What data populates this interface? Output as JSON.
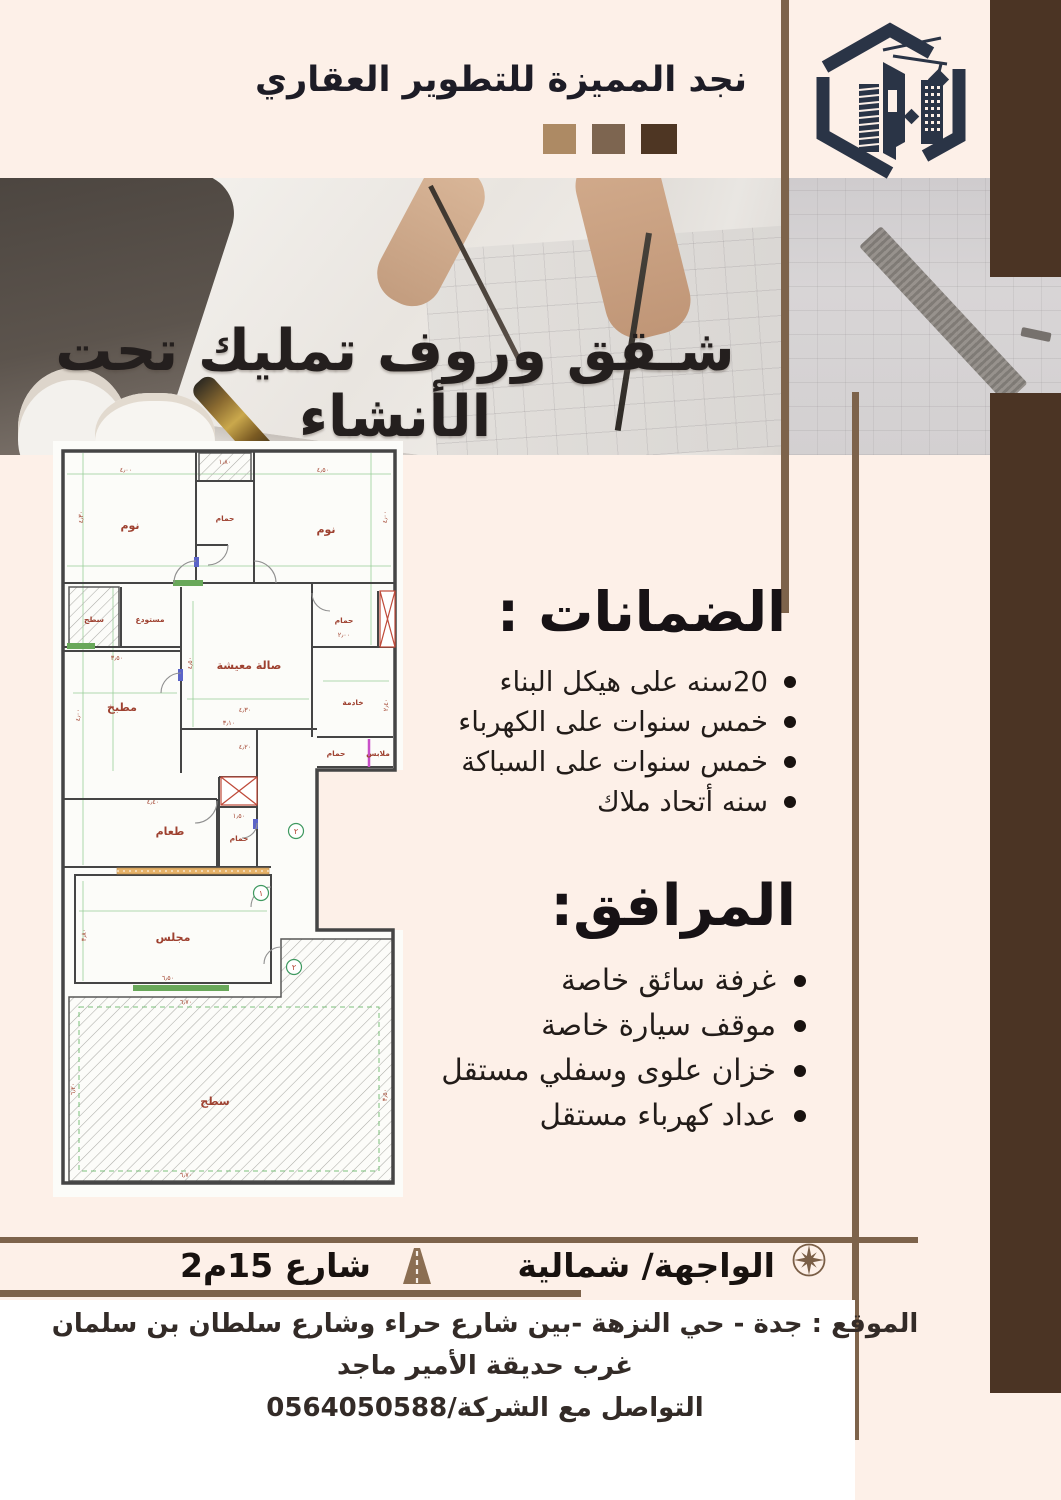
{
  "header": {
    "company_name": "نجد المميزة للتطوير العقاري",
    "squares": [
      "#ad8a64",
      "#7d6550",
      "#4e3623"
    ],
    "logo_color": "#2a3446"
  },
  "banner": {
    "title": "شـقق وروف تمليك تحت الأنشاء"
  },
  "guarantees": {
    "heading": "الضمانات :",
    "items": [
      "20سنه على هيكل البناء",
      "خمس سنوات على الكهرباء",
      "خمس سنوات على السباكة",
      "سنه أتحاد ملاك"
    ]
  },
  "facilities": {
    "heading": "المرافق:",
    "items": [
      "غرفة سائق خاصة",
      "موقف سيارة خاصة",
      "خزان علوى وسفلي مستقل",
      "عداد كهرباء مستقل"
    ]
  },
  "footer_bar": {
    "facade_label": "الواجهة/ شمالية",
    "street_label": "شارع 15م2",
    "compass_icon": "compass-icon",
    "road_icon": "road-icon"
  },
  "location": {
    "line1": "الموقع : جدة - حي النزهة -بين شارع حراء وشارع سلطان بن سلمان غرب حديقة الأمير ماجد",
    "line2": "التواصل مع الشركة/0564050588"
  },
  "colors": {
    "background_pink": "#fdf0e8",
    "stripe_dark_brown": "#4b3424",
    "rule_brown": "#7d634b",
    "text_dark": "#18120f",
    "plan_label_red": "#9e4130"
  },
  "floor_plan": {
    "room_labels": [
      {
        "t": "نوم",
        "x": 77,
        "y": 88
      },
      {
        "t": "حمام",
        "x": 172,
        "y": 80,
        "size": "small"
      },
      {
        "t": "نوم",
        "x": 273,
        "y": 92
      },
      {
        "t": "سطح",
        "x": 41,
        "y": 181,
        "size": "small"
      },
      {
        "t": "مستودع",
        "x": 97,
        "y": 181,
        "size": "small"
      },
      {
        "t": "صالة معيشة",
        "x": 196,
        "y": 228
      },
      {
        "t": "حمام",
        "x": 291,
        "y": 182,
        "size": "small"
      },
      {
        "t": "مطبخ",
        "x": 69,
        "y": 270
      },
      {
        "t": "خادمة",
        "x": 300,
        "y": 264,
        "size": "small"
      },
      {
        "t": "حمام",
        "x": 283,
        "y": 315,
        "size": "small"
      },
      {
        "t": "ملابس",
        "x": 325,
        "y": 315,
        "size": "small"
      },
      {
        "t": "طعام",
        "x": 117,
        "y": 394
      },
      {
        "t": "حمام",
        "x": 186,
        "y": 400,
        "size": "small"
      },
      {
        "t": "مجلس",
        "x": 120,
        "y": 500
      },
      {
        "t": "سطح",
        "x": 162,
        "y": 664
      }
    ],
    "dim_labels": [
      {
        "t": "٤٫٠٠",
        "x": 73,
        "y": 31
      },
      {
        "t": "٤٫٣٠",
        "x": 30,
        "y": 76,
        "r": -90
      },
      {
        "t": "١٫٨٠",
        "x": 172,
        "y": 23
      },
      {
        "t": "٤٫٥٠",
        "x": 270,
        "y": 31
      },
      {
        "t": "٤٫٠٠",
        "x": 334,
        "y": 76,
        "r": -90
      },
      {
        "t": "٣٫٥٠",
        "x": 64,
        "y": 219
      },
      {
        "t": "٤٫٠٠",
        "x": 27,
        "y": 274,
        "r": -90
      },
      {
        "t": "٤٫٥٠",
        "x": 139,
        "y": 222,
        "r": -90
      },
      {
        "t": "٤٫٣٠",
        "x": 192,
        "y": 271
      },
      {
        "t": "٣٫١٠",
        "x": 176,
        "y": 284
      },
      {
        "t": "٢٫٠٠",
        "x": 291,
        "y": 196
      },
      {
        "t": "٢٫٤٠",
        "x": 335,
        "y": 264,
        "r": -90
      },
      {
        "t": "٤٫٢٠",
        "x": 192,
        "y": 308
      },
      {
        "t": "١٫٥٠",
        "x": 186,
        "y": 377
      },
      {
        "t": "٤٫٤٠",
        "x": 100,
        "y": 363
      },
      {
        "t": "٣٫٨٠",
        "x": 33,
        "y": 494,
        "r": -90
      },
      {
        "t": "٦٫٥٠",
        "x": 115,
        "y": 539
      },
      {
        "t": "٦٫٧٠",
        "x": 133,
        "y": 563
      },
      {
        "t": "٦٫٧٠",
        "x": 133,
        "y": 736
      },
      {
        "t": "٦٫٢٠",
        "x": 22,
        "y": 648,
        "r": -90
      },
      {
        "t": "٣٫٥٠",
        "x": 334,
        "y": 654,
        "r": -90
      }
    ],
    "door_numbers": [
      {
        "t": "٢",
        "x": 243,
        "y": 393
      },
      {
        "t": "١",
        "x": 208,
        "y": 455
      },
      {
        "t": "٢",
        "x": 241,
        "y": 529
      }
    ]
  }
}
